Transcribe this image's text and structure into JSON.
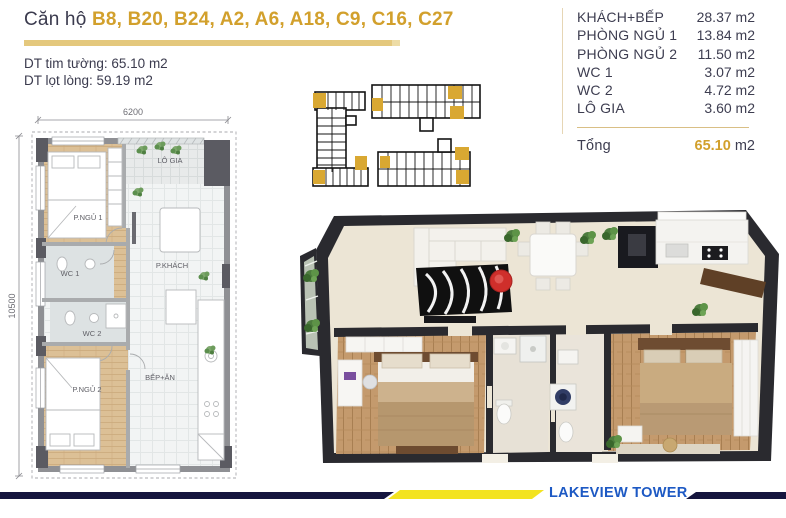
{
  "header": {
    "title_prefix": "Căn hộ ",
    "unit_list": "B8, B20, B24, A2, A6, A18, C9, C16, C27",
    "area_gross": "DT tim tường: 65.10 m2",
    "area_net": "DT lọt lòng: 59.19 m2"
  },
  "area_table": {
    "rows": [
      {
        "label": "KHÁCH+BẾP",
        "value": "28.37",
        "unit": "m2"
      },
      {
        "label": "PHÒNG NGỦ 1",
        "value": "13.84",
        "unit": "m2"
      },
      {
        "label": "PHÒNG NGỦ 2",
        "value": "11.50",
        "unit": "m2"
      },
      {
        "label": "WC 1",
        "value": "3.07",
        "unit": "m2"
      },
      {
        "label": "WC 2",
        "value": "4.72",
        "unit": "m2"
      },
      {
        "label": "LÔ GIA",
        "value": "3.60",
        "unit": "m2"
      }
    ],
    "total_label": "Tổng",
    "total_value": "65.10",
    "total_unit": "m2"
  },
  "floor_plan": {
    "dim_width": "6200",
    "dim_height": "10500",
    "labels": {
      "lo_gia": "LÔ GIA",
      "bedroom1": "P.NGỦ 1",
      "wc1": "WC 1",
      "living": "P.KHÁCH",
      "wc2": "WC 2",
      "bedroom2": "P.NGỦ 2",
      "kitchen": "BẾP+ĂN"
    }
  },
  "footer": {
    "brand": "LAKEVIEW TOWER"
  },
  "colors": {
    "accent_gold": "#d2a02c",
    "bar_gold": "#e4c87d",
    "navy": "#15153e",
    "footer_yellow": "#f3e31f",
    "brand_blue": "#1d59c4"
  }
}
